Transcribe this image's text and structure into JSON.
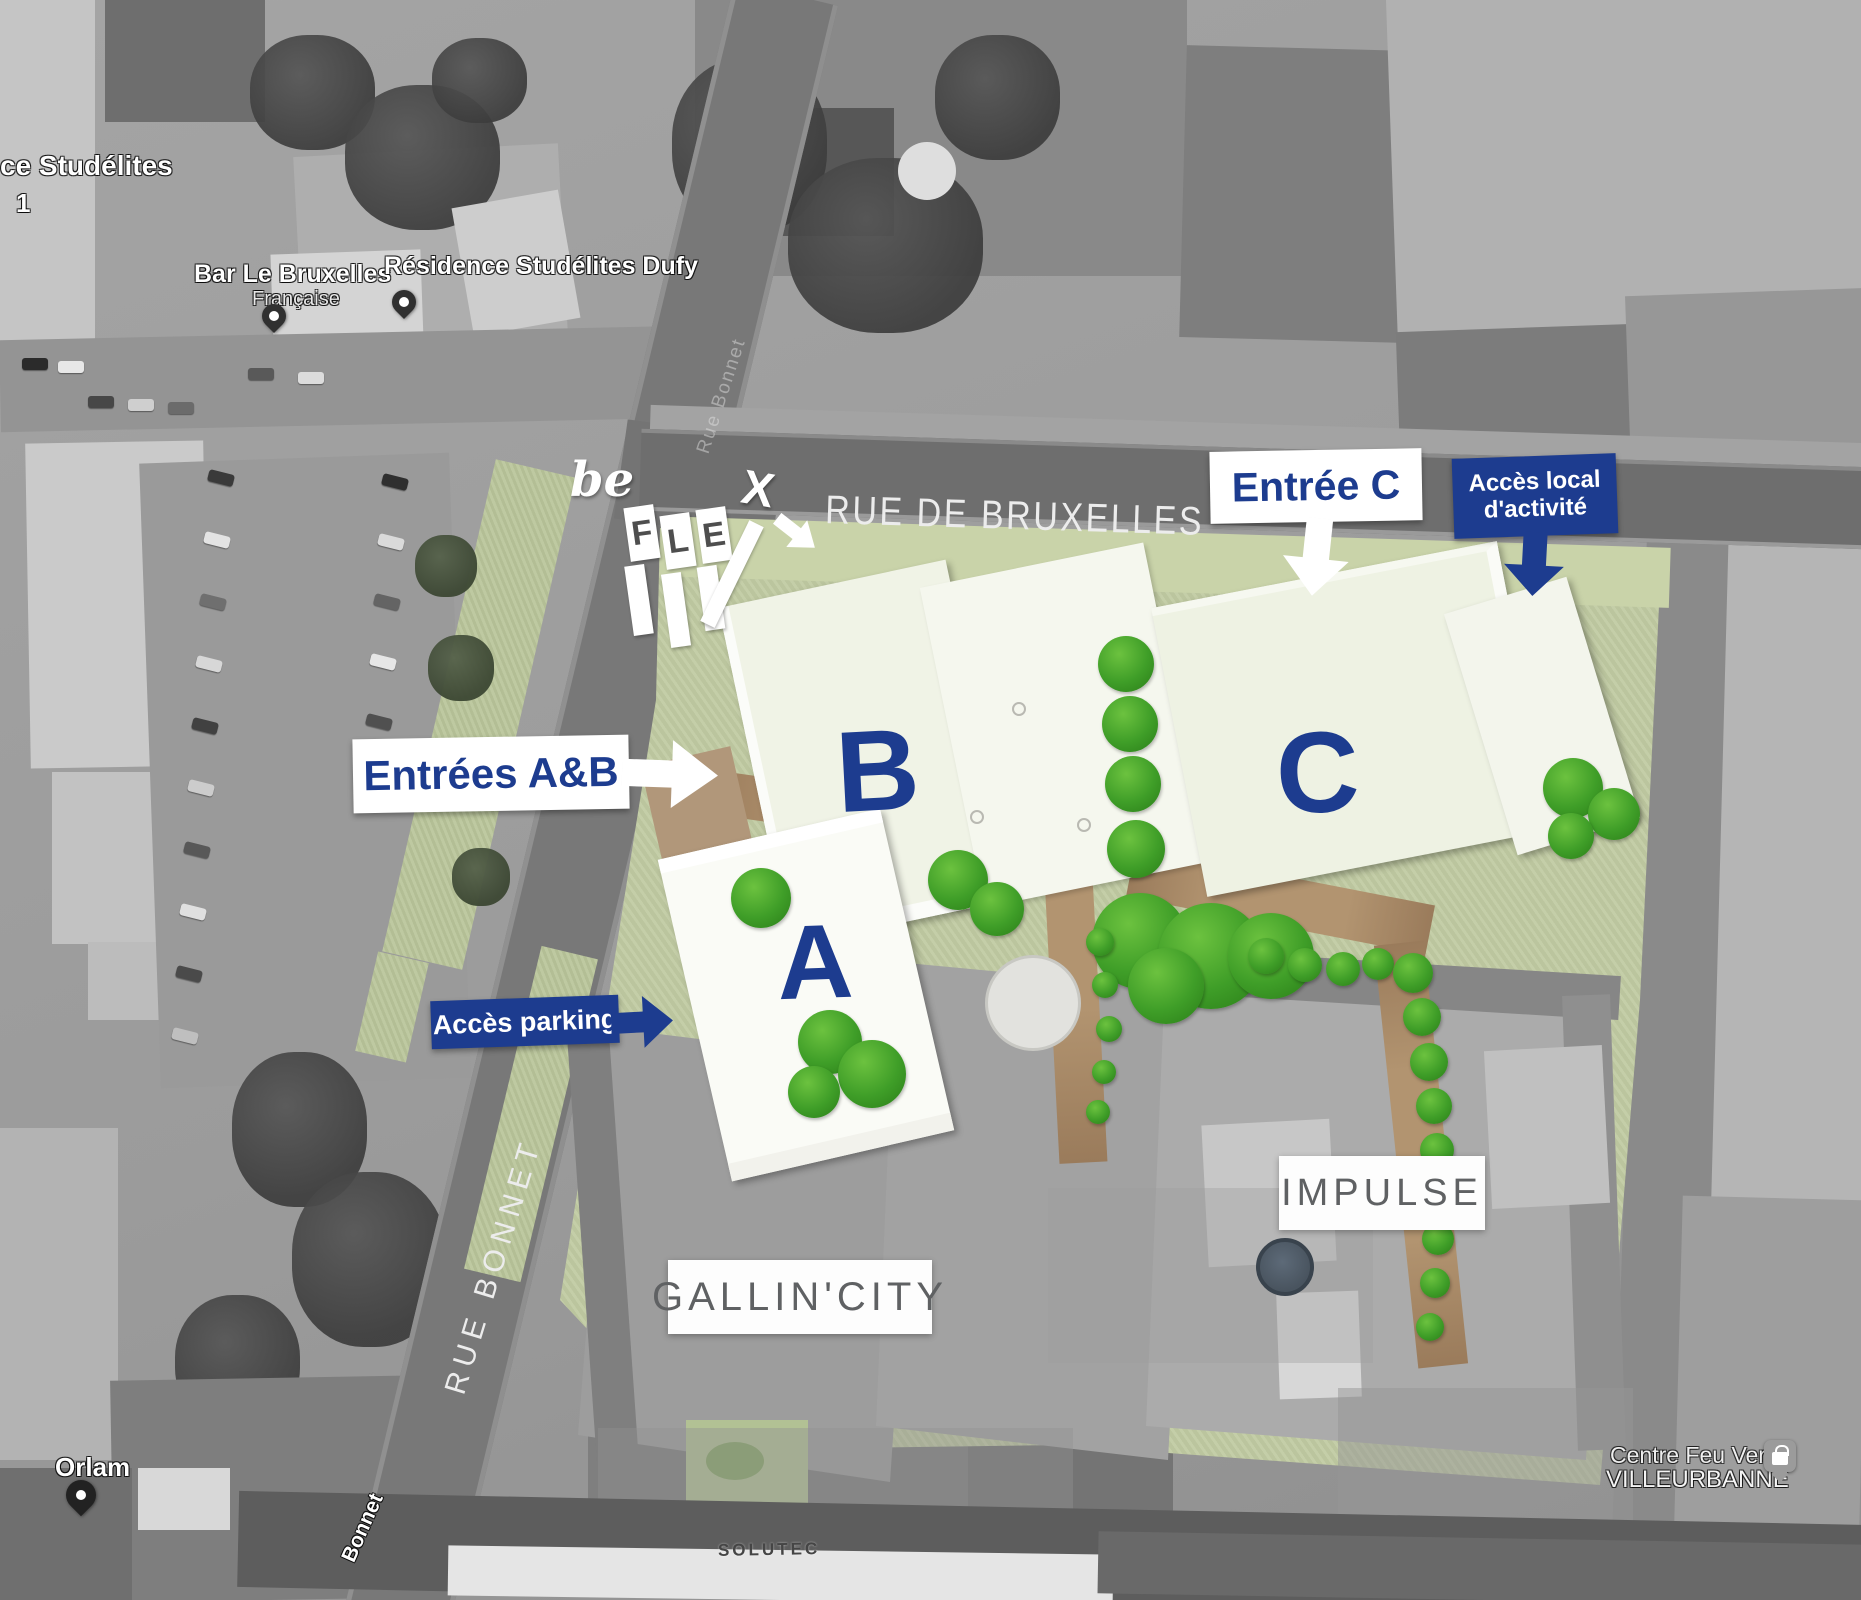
{
  "plan": {
    "street_bruxelles": "RUE DE BRUXELLES",
    "street_bonnet": "RUE BONNET",
    "building_a": "A",
    "building_b": "B",
    "building_c": "C",
    "label_gallin": "GALLIN'CITY",
    "label_impulse": "IMPULSE"
  },
  "logo": {
    "be": "be",
    "f": "F",
    "l": "L",
    "e": "E",
    "x": "X"
  },
  "callouts": {
    "entree_c": "Entrée C",
    "acces_local_l1": "Accès local",
    "acces_local_l2": "d'activité",
    "entrees_ab": "Entrées A&B",
    "acces_parking": "Accès parking"
  },
  "map_labels": {
    "studelites_l1": "ce Studélites",
    "studelites_l2": "1",
    "bar_l1": "Bar Le Bruxelles",
    "bar_l2": "Française",
    "residence": "Résidence Studélites Dufy",
    "bonnet_faint": "Rue Bonnet",
    "bonnet_small": "Bonnet",
    "orlam": "Orlam",
    "solutec": "SOLUTEC",
    "feuvert_l1": "Centre Feu Vert",
    "feuvert_l2": "VILLEURBANNE"
  },
  "colors": {
    "accent_blue": "#1d3c8f",
    "plan_green": "#c1cba3",
    "bush_green": "#3f9e28",
    "path_brown": "#ae8d6a",
    "callout_white": "#ffffff"
  }
}
